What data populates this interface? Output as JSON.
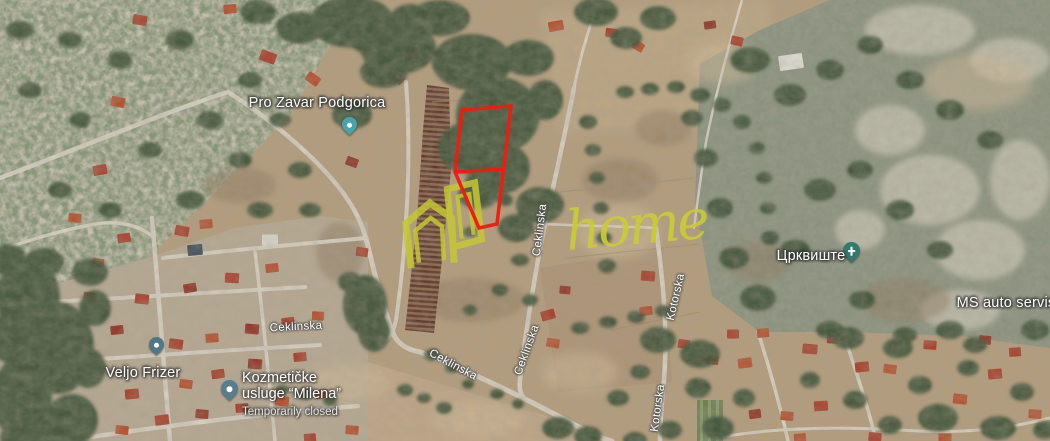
{
  "map": {
    "view": "satellite",
    "watermark": {
      "text": "home",
      "color": "#c9cc36"
    },
    "parcel": {
      "color": "#ee1c0f"
    },
    "place_labels": [
      {
        "text": "Pro Zavar Podgorica",
        "pin_color": "#47a4ab"
      },
      {
        "text": "Veljo Frizer",
        "pin_color": "#4d7884"
      },
      {
        "line1": "Kozmetičke",
        "line2": "usluge “Milena”",
        "status": "Temporarily closed",
        "pin_color": "#567f8b"
      },
      {
        "text": "Црквиште",
        "pin_color": "#35796e",
        "pin_glyph": "cross"
      },
      {
        "text": "MS auto servis"
      }
    ],
    "road_labels": [
      {
        "text": "Ceklinska"
      },
      {
        "text": "Ceklinska"
      },
      {
        "text": "Ceklinska"
      },
      {
        "text": "Ceklinska"
      },
      {
        "text": "Kotorska"
      },
      {
        "text": "Kotorska"
      }
    ]
  }
}
